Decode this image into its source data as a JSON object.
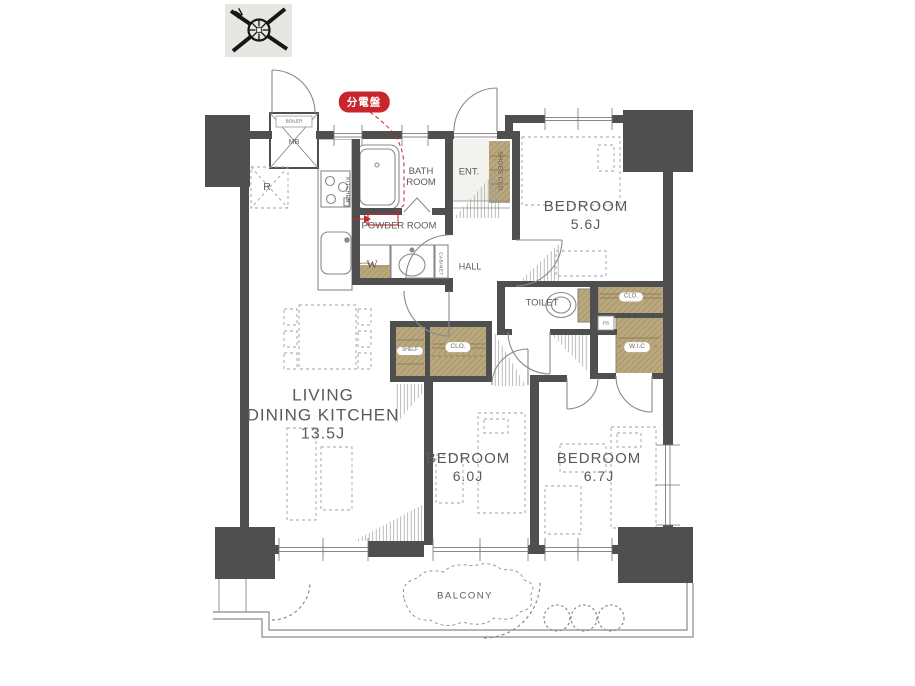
{
  "floorplan": {
    "compass": {
      "north": "N"
    },
    "badge": {
      "label": "分電盤"
    },
    "rooms": {
      "ldk": {
        "line1": "LIVING",
        "line2": "DINING KITCHEN",
        "size": "13.5J"
      },
      "bedroom_a": {
        "name": "BEDROOM",
        "size": "5.6J"
      },
      "bedroom_b": {
        "name": "BEDROOM",
        "size": "6.0J"
      },
      "bedroom_c": {
        "name": "BEDROOM",
        "size": "6.7J"
      },
      "bath": {
        "line1": "BATH",
        "line2": "ROOM"
      },
      "powder": {
        "name": "POWDER ROOM"
      },
      "ent": {
        "name": "ENT."
      },
      "hall": {
        "name": "HALL"
      },
      "toilet": {
        "name": "TOILET"
      },
      "balcony": {
        "name": "BALCONY"
      }
    },
    "storage": {
      "shoes_clo": "SHOES CLO.",
      "clo_bedroom_a": "CLO.",
      "clo_hall": "CLO.",
      "shelf": "SHELF",
      "wic": "W.I.C",
      "cabinet": "CABINET"
    },
    "equipment": {
      "boiler": "BOILER",
      "meter_box": "MB",
      "refrigerator": "R",
      "washer": "W",
      "kitchen": "KITCHEN",
      "pipe_space": "PS"
    },
    "colors": {
      "wall": "#4f4f4f",
      "closet": "#b9a77d",
      "badge_red": "#c8252c",
      "text": "#5a5a5a",
      "line": "#8a8a8a"
    }
  }
}
